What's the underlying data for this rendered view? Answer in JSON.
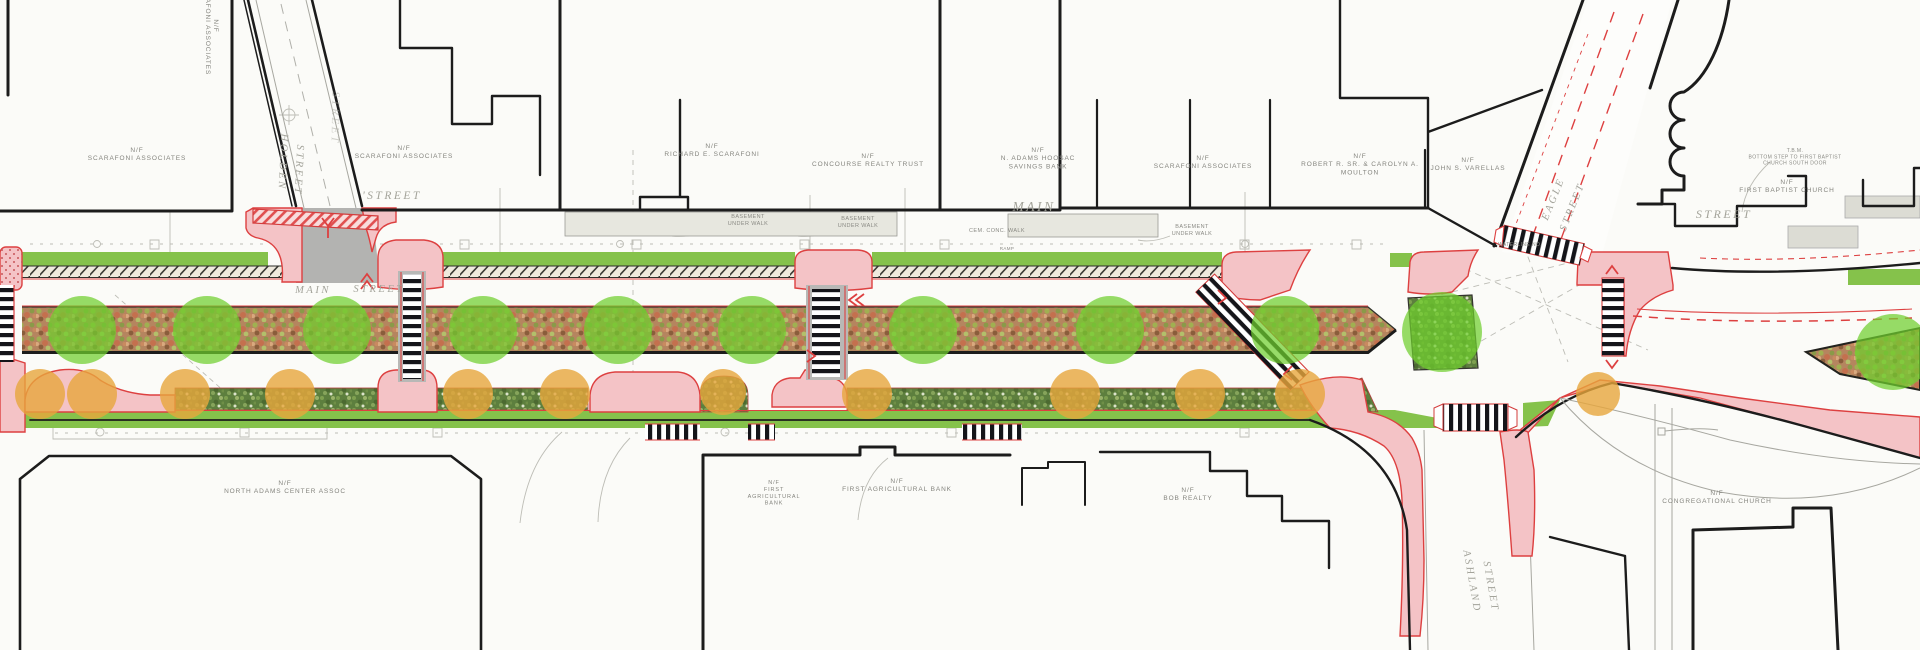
{
  "drawing": {
    "kind": "streetscape improvement plan (plan view)",
    "colors": {
      "paper": "#fbfbf8",
      "pink": "#f4c3c6",
      "red": "#dd4040",
      "lawn": "#85c24b",
      "tree": "#6fce2e",
      "shrub_canopy": "#e7a63c",
      "bed_base": "#b5855f",
      "shrub_bed": "#5d7f3e",
      "street_gray": "#b3b3b1",
      "walk_gray": "#e3e3db",
      "ink": "#1c1c1c",
      "label_gray": "#8a8a84"
    },
    "labels": [
      {
        "name": "parcel-scarafoni-vert",
        "cls": "parcel",
        "x": 214,
        "y": 26,
        "rotate": 90,
        "size": 6.5,
        "lines": [
          "N/F",
          "SCARAFONI ASSOCIATES"
        ]
      },
      {
        "name": "parcel-scarafoni-a",
        "cls": "parcel",
        "x": 137,
        "y": 152,
        "size": 6.5,
        "lines": [
          "N/F",
          "SCARAFONI ASSOCIATES"
        ]
      },
      {
        "name": "parcel-scarafoni-b",
        "cls": "parcel",
        "x": 404,
        "y": 150,
        "size": 6.5,
        "lines": [
          "N/F",
          "SCARAFONI ASSOCIATES"
        ]
      },
      {
        "name": "parcel-richard-scarafoni",
        "cls": "parcel",
        "x": 712,
        "y": 148,
        "size": 6.5,
        "lines": [
          "N/F",
          "RICHARD E. SCARAFONI"
        ]
      },
      {
        "name": "parcel-concourse",
        "cls": "parcel",
        "x": 868,
        "y": 158,
        "size": 6.5,
        "lines": [
          "N/F",
          "CONCOURSE REALTY TRUST"
        ]
      },
      {
        "name": "parcel-hoosac-bank",
        "cls": "parcel",
        "x": 1038,
        "y": 152,
        "size": 6.5,
        "lines": [
          "N/F",
          "N. ADAMS HOOSAC",
          "SAVINGS BANK"
        ]
      },
      {
        "name": "parcel-scarafoni-c",
        "cls": "parcel",
        "x": 1203,
        "y": 160,
        "size": 6.5,
        "lines": [
          "N/F",
          "SCARAFONI ASSOCIATES"
        ]
      },
      {
        "name": "parcel-moulton",
        "cls": "parcel",
        "x": 1360,
        "y": 158,
        "size": 6.5,
        "lines": [
          "N/F",
          "ROBERT R. SR. & CAROLYN A.",
          "MOULTON"
        ]
      },
      {
        "name": "parcel-varellas",
        "cls": "parcel",
        "x": 1468,
        "y": 162,
        "size": 6.5,
        "lines": [
          "N/F",
          "JOHN S. VARELLAS"
        ]
      },
      {
        "name": "parcel-first-baptist",
        "cls": "parcel",
        "x": 1787,
        "y": 184,
        "size": 6.5,
        "lines": [
          "N/F",
          "FIRST BAPTIST CHURCH"
        ]
      },
      {
        "name": "parcel-na-center",
        "cls": "parcel",
        "x": 285,
        "y": 485,
        "size": 6.5,
        "lines": [
          "N/F",
          "NORTH ADAMS CENTER ASSOC"
        ]
      },
      {
        "name": "parcel-agri-bank-small",
        "cls": "parcel",
        "x": 774,
        "y": 484,
        "size": 5.5,
        "lines": [
          "N/F",
          "FIRST",
          "AGRICULTURAL",
          "BANK"
        ]
      },
      {
        "name": "parcel-agri-bank",
        "cls": "parcel",
        "x": 897,
        "y": 483,
        "size": 6.5,
        "lines": [
          "N/F",
          "FIRST AGRICULTURAL BANK"
        ]
      },
      {
        "name": "parcel-bob-realty",
        "cls": "parcel",
        "x": 1188,
        "y": 492,
        "size": 6.5,
        "lines": [
          "N/F",
          "BOB REALTY"
        ]
      },
      {
        "name": "parcel-cong-church",
        "cls": "parcel",
        "x": 1717,
        "y": 495,
        "size": 6.5,
        "lines": [
          "N/F",
          "CONGREGATIONAL CHURCH"
        ]
      },
      {
        "name": "street-holden",
        "cls": "street",
        "x": 280,
        "y": 162,
        "rotate": 93,
        "size": 10.5,
        "lines": [
          "HOLDEN"
        ]
      },
      {
        "name": "street-holden-2",
        "cls": "street",
        "x": 296,
        "y": 170,
        "rotate": 93,
        "size": 10.5,
        "lines": [
          "STREET"
        ]
      },
      {
        "name": "street-faint-vert",
        "cls": "street",
        "x": 332,
        "y": 118,
        "rotate": 91,
        "size": 11,
        "faint": true,
        "lines": [
          "STREET"
        ]
      },
      {
        "name": "street-tick",
        "cls": "street",
        "x": 392,
        "y": 199,
        "size": 11.5,
        "lines": [
          "'STREET"
        ]
      },
      {
        "name": "street-main-w",
        "cls": "street",
        "x": 313,
        "y": 293,
        "size": 10.5,
        "lines": [
          "MAIN"
        ]
      },
      {
        "name": "street-main-w2",
        "cls": "street",
        "x": 379,
        "y": 292,
        "size": 10.5,
        "lines": [
          "STREET"
        ]
      },
      {
        "name": "street-main-big",
        "cls": "street",
        "x": 1034,
        "y": 211,
        "size": 13.5,
        "lines": [
          "MAIN"
        ]
      },
      {
        "name": "street-e",
        "cls": "street",
        "x": 1724,
        "y": 218,
        "size": 12,
        "lines": [
          "STREET"
        ]
      },
      {
        "name": "street-eagle",
        "cls": "street",
        "x": 1556,
        "y": 200,
        "rotate": -68,
        "size": 10.5,
        "lines": [
          "EAGLE"
        ]
      },
      {
        "name": "street-eagle-2",
        "cls": "street",
        "x": 1575,
        "y": 208,
        "rotate": -68,
        "size": 10.5,
        "lines": [
          "STREET"
        ]
      },
      {
        "name": "street-ashland",
        "cls": "street",
        "x": 1469,
        "y": 582,
        "rotate": 80,
        "size": 10.5,
        "lines": [
          "ASHLAND"
        ]
      },
      {
        "name": "street-ashland-2",
        "cls": "street",
        "x": 1488,
        "y": 587,
        "rotate": 80,
        "size": 10.5,
        "lines": [
          "STREET"
        ]
      },
      {
        "name": "note-basement-1",
        "cls": "note",
        "x": 748,
        "y": 218,
        "size": 5.5,
        "lines": [
          "BASEMENT",
          "UNDER WALK"
        ]
      },
      {
        "name": "note-basement-2",
        "cls": "note",
        "x": 858,
        "y": 220,
        "size": 5.5,
        "lines": [
          "BASEMENT",
          "UNDER WALK"
        ]
      },
      {
        "name": "note-basement-3",
        "cls": "note",
        "x": 1192,
        "y": 228,
        "size": 5.5,
        "lines": [
          "BASEMENT",
          "UNDER WALK"
        ]
      },
      {
        "name": "note-cem-walk",
        "cls": "note",
        "x": 997,
        "y": 232,
        "size": 5.5,
        "lines": [
          "CEM. CONC. WALK"
        ]
      },
      {
        "name": "note-tbm",
        "cls": "note",
        "x": 1795,
        "y": 152,
        "size": 5,
        "lines": [
          "T.B.M.",
          "BOTTOM STEP TO FIRST BAPTIST",
          "CHURCH SOUTH DOOR"
        ]
      },
      {
        "name": "note-waterline",
        "cls": "note",
        "x": 1520,
        "y": 246,
        "size": 5,
        "lines": [
          "WATERLINE NO."
        ]
      },
      {
        "name": "note-ramp",
        "cls": "note",
        "x": 1007,
        "y": 250,
        "size": 4.5,
        "lines": [
          "RAMP"
        ]
      }
    ],
    "planting": {
      "trees": {
        "default_r": 34,
        "opacity": 0.72,
        "points": [
          [
            82,
            330
          ],
          [
            207,
            330
          ],
          [
            337,
            330
          ],
          [
            483,
            330
          ],
          [
            618,
            330
          ],
          [
            752,
            330
          ],
          [
            923,
            330
          ],
          [
            1110,
            330
          ],
          [
            1285,
            330
          ],
          [
            1442,
            332,
            40
          ],
          [
            1893,
            352,
            38
          ]
        ]
      },
      "shrubs": {
        "default_r": 25,
        "opacity": 0.8,
        "points": [
          [
            40,
            394
          ],
          [
            92,
            394
          ],
          [
            185,
            394
          ],
          [
            290,
            394
          ],
          [
            468,
            394
          ],
          [
            565,
            394
          ],
          [
            723,
            392,
            23
          ],
          [
            867,
            394
          ],
          [
            1075,
            394
          ],
          [
            1200,
            394
          ],
          [
            1300,
            394
          ],
          [
            1598,
            394,
            22
          ]
        ]
      }
    },
    "parking_meters": {
      "north_y": 283,
      "north_x": [
        62,
        105,
        148,
        190,
        232,
        440,
        483,
        527,
        571,
        615,
        659,
        703,
        747,
        1012,
        1057,
        1102,
        1147,
        1192,
        1238,
        1284,
        1330,
        1376
      ],
      "south_y": 374,
      "south_x": [
        60,
        98,
        140,
        182,
        224,
        265,
        306,
        347,
        570,
        892,
        937,
        1057,
        1128,
        1167,
        1205,
        1245,
        1284,
        1326
      ],
      "rotated": [
        [
          1715,
          278,
          -20
        ],
        [
          1762,
          281,
          -20
        ],
        [
          1807,
          279,
          -25
        ],
        [
          1853,
          283,
          -25
        ],
        [
          1807,
          393,
          40
        ],
        [
          1858,
          413,
          45
        ],
        [
          1906,
          438,
          50
        ]
      ]
    }
  }
}
